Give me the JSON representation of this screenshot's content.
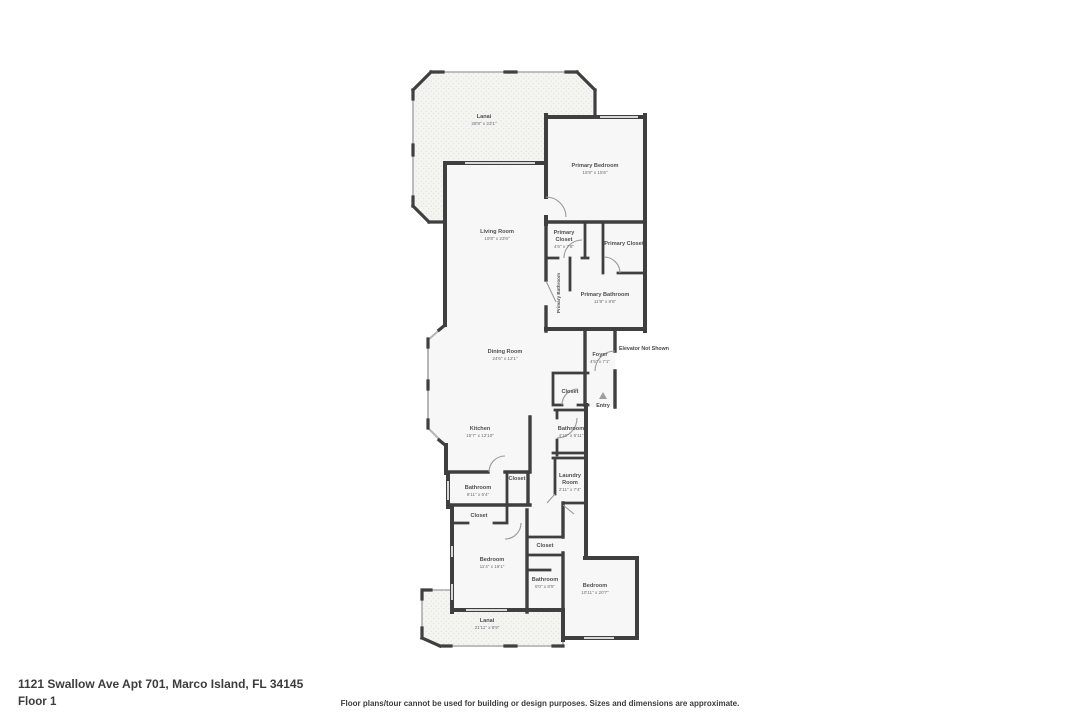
{
  "page": {
    "address": "1121 Swallow Ave Apt 701, Marco Island, FL 34145",
    "floor_label": "Floor 1",
    "disclaimer": "Floor plans/tour cannot be used for building or design purposes. Sizes and dimensions are approximate."
  },
  "plan": {
    "entry_label": "Entry",
    "elevator_note": "Elevator Not Shown",
    "rooms": {
      "lanai_top": {
        "name": "Lanai",
        "dims": "28'8\" x 23'1\""
      },
      "primary_bedroom": {
        "name": "Primary Bedroom",
        "dims": "15'9\" x 15'6\""
      },
      "living_room": {
        "name": "Living Room",
        "dims": "19'8\" x 23'6\""
      },
      "primary_closet_left": {
        "line1": "Primary",
        "line2": "Closet",
        "dims": "4'6\" x 7'8\""
      },
      "primary_closet_right": {
        "name": "Primary Closet"
      },
      "primary_bathroom_hall": {
        "name": "Primary Bathroom"
      },
      "primary_bathroom": {
        "name": "Primary Bathroom",
        "dims": "11'9\" x 9'8\""
      },
      "dining_room": {
        "name": "Dining Room",
        "dims": "24'6\" x 12'1\""
      },
      "foyer": {
        "name": "Foyer",
        "dims": "4'5\" x 7'1\""
      },
      "closet_foyer": {
        "name": "Closet"
      },
      "kitchen": {
        "name": "Kitchen",
        "dims": "15'7\" x 12'10\""
      },
      "bathroom_hall": {
        "name": "Bathroom",
        "dims": "4'10\" x 6'11\""
      },
      "laundry_room": {
        "line1": "Laundry",
        "line2": "Room",
        "dims": "2'11\" x 7'4\""
      },
      "closet_kitchen": {
        "name": "Closet"
      },
      "bathroom_left": {
        "name": "Bathroom",
        "dims": "8'11\" x 5'4\""
      },
      "closet_bedroom_left": {
        "name": "Closet"
      },
      "bedroom_left": {
        "name": "Bedroom",
        "dims": "11'4\" x 19'1\""
      },
      "closet_mid": {
        "name": "Closet"
      },
      "bathroom_mid": {
        "name": "Bathroom",
        "dims": "5'0\" x 8'5\""
      },
      "bedroom_right": {
        "name": "Bedroom",
        "dims": "10'11\" x 20'7\""
      },
      "lanai_bottom": {
        "name": "Lanai",
        "dims": "21'11\" x 8'9\""
      }
    }
  },
  "colors": {
    "wall": "#3f3f3f",
    "room_fill": "#f7f7f7",
    "lanai_fill": "#f4f4f1",
    "window": "#d8d8d8",
    "label": "#4f4f4f"
  }
}
